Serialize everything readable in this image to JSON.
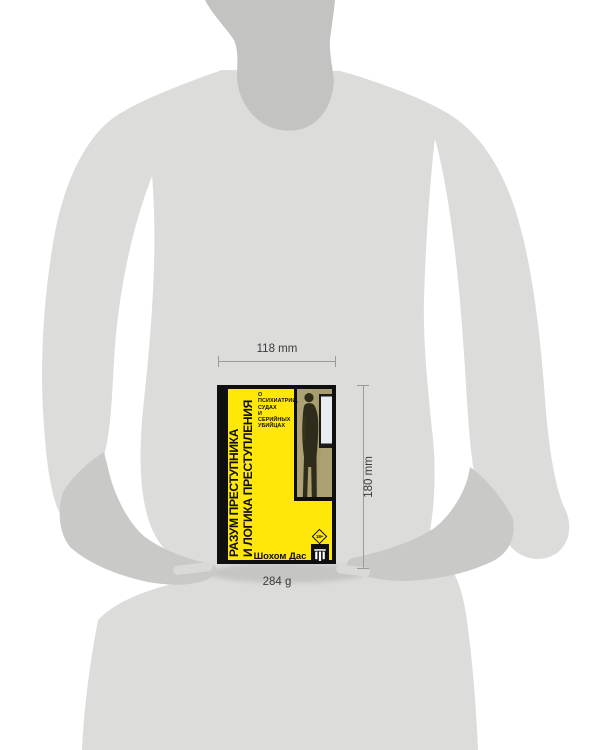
{
  "annotations": {
    "width_label": "118 mm",
    "height_label": "180 mm",
    "weight_label": "284 g"
  },
  "book": {
    "title_line1": "РАЗУМ ПРЕСТУПНИКА",
    "title_line2": "И ЛОГИКА ПРЕСТУПЛЕНИЯ",
    "subtitle_lines": [
      "О ПСИХИАТРИИ,",
      "СУДАХ",
      "И СЕРИЙНЫХ",
      "УБИЙЦАХ"
    ],
    "author": "Шохом Дас",
    "age_badge": "18+"
  },
  "icons": {
    "publisher_logo": "individuum-bars-logo",
    "age_badge_shape": "diamond-outline"
  },
  "colors": {
    "cover_yellow": "#FFE70A",
    "ink": "#0F0F0F",
    "photo_olive": "#A89D6E",
    "body": "#DCDCDB",
    "neck": "#C3C3C2",
    "limb": "#C9C9C7",
    "line": "#9B9B9B",
    "label": "#3C3C3C"
  }
}
